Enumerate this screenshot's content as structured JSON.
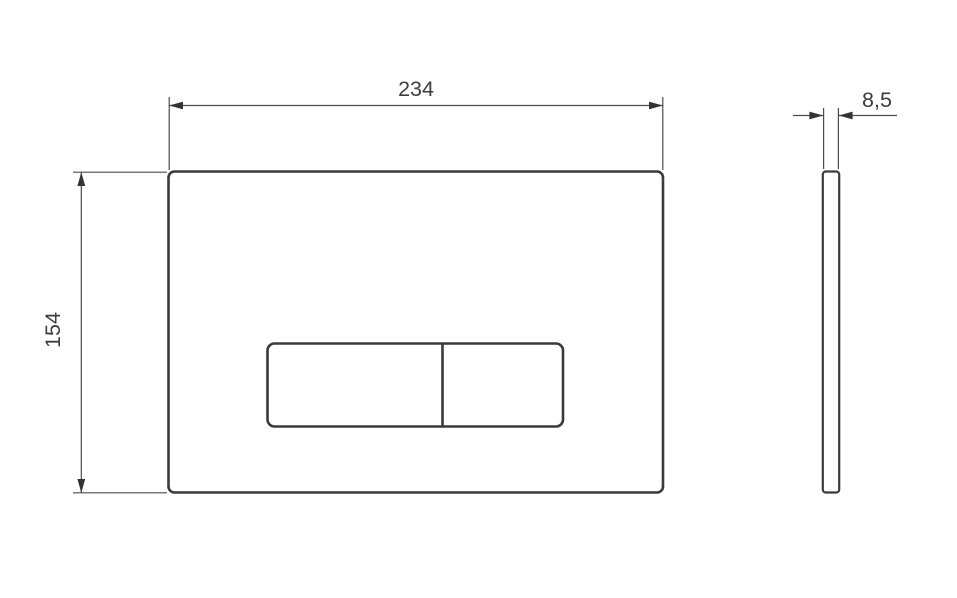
{
  "page": {
    "background": "#ffffff"
  },
  "drawing": {
    "description": "Technical dimension drawing of a rectangular flush plate with dual buttons: front view and side profile view",
    "front_view": {
      "width_label": "234",
      "height_label": "154"
    },
    "side_view": {
      "thickness_label": "8,5"
    },
    "colors": {
      "outline": "#3a3a3a",
      "dimension_line": "#4c4c4c",
      "arrow": "#333333",
      "text": "#3c3c3c"
    }
  }
}
